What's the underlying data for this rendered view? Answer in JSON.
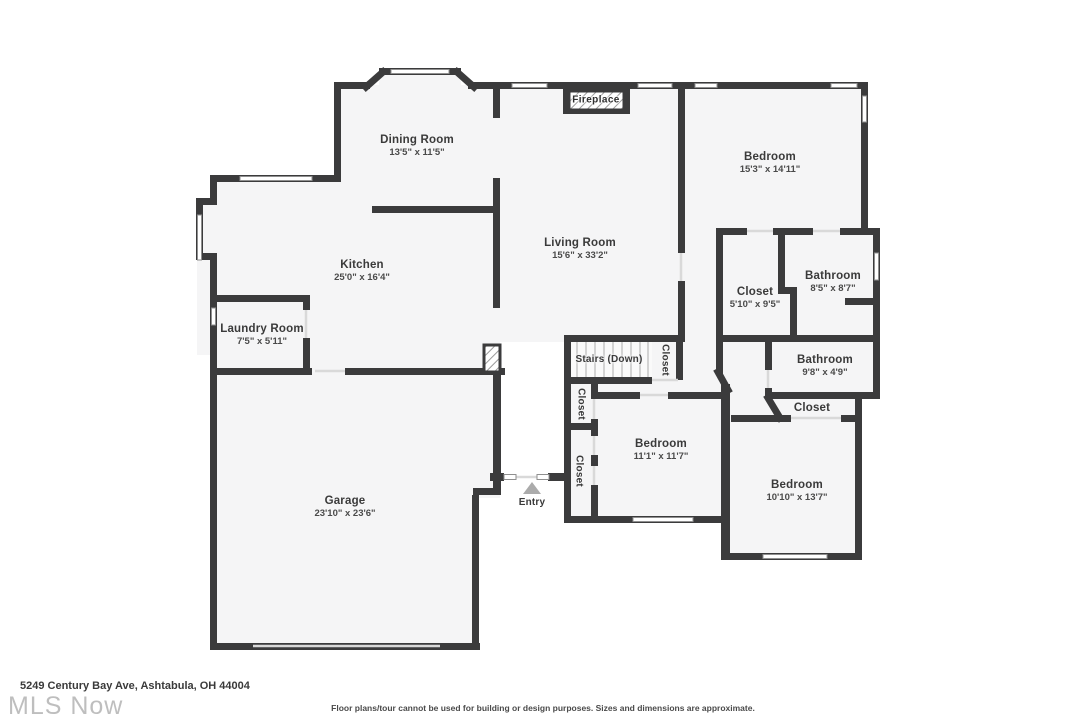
{
  "rooms": {
    "dining": {
      "name": "Dining Room",
      "dims": "13'5\" x 11'5\""
    },
    "kitchen": {
      "name": "Kitchen",
      "dims": "25'0\" x 16'4\""
    },
    "living": {
      "name": "Living Room",
      "dims": "15'6\" x 33'2\""
    },
    "bedroom_ne": {
      "name": "Bedroom",
      "dims": "15'3\" x 14'11\""
    },
    "closet_primary": {
      "name": "Closet",
      "dims": "5'10\" x 9'5\""
    },
    "bathroom_main": {
      "name": "Bathroom",
      "dims": "8'5\" x 8'7\""
    },
    "laundry": {
      "name": "Laundry Room",
      "dims": "7'5\" x 5'11\""
    },
    "bathroom_hall": {
      "name": "Bathroom",
      "dims": "9'8\" x 4'9\""
    },
    "closet_bedroom": {
      "name": "Closet"
    },
    "bedroom_mid": {
      "name": "Bedroom",
      "dims": "11'1\" x 11'7\""
    },
    "bedroom_se": {
      "name": "Bedroom",
      "dims": "10'10\" x 13'7\""
    },
    "garage": {
      "name": "Garage",
      "dims": "23'10\" x 23'6\""
    },
    "stairs": {
      "name": "Stairs (Down)"
    },
    "closet_stairs": {
      "name": "Closet"
    },
    "closet_hall_upper": {
      "name": "Closet"
    },
    "closet_hall_lower": {
      "name": "Closet"
    },
    "entry": {
      "name": "Entry"
    },
    "fireplace": {
      "name": "Fireplace"
    }
  },
  "footer": {
    "address": "5249 Century Bay Ave, Ashtabula, OH 44004",
    "watermark": "MLS Now",
    "disclaimer": "Floor plans/tour cannot be used for building or design purposes. Sizes and dimensions are approximate."
  },
  "colors": {
    "wall": "#3b3b3c",
    "floor": "#f5f5f6",
    "text": "#3a3a3a",
    "watermark": "#a9a9a9"
  }
}
